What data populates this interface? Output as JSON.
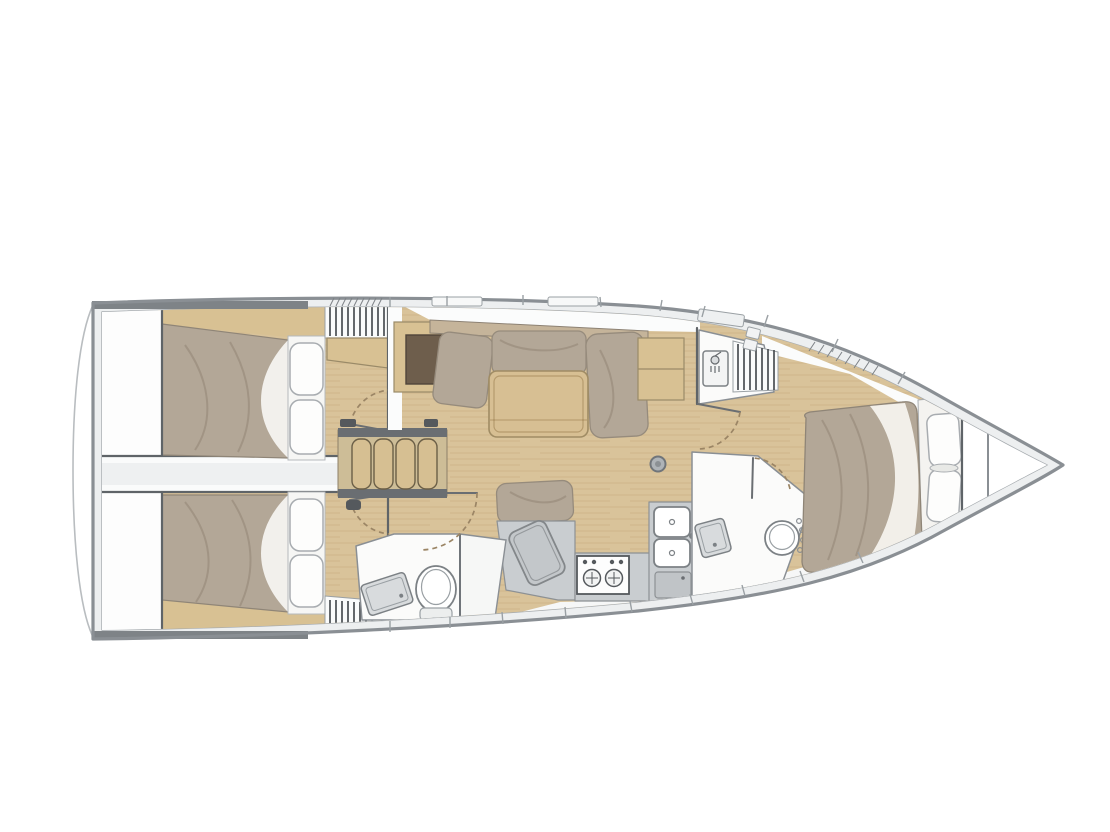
{
  "diagram": {
    "type": "sailboat-interior-floor-plan",
    "orientation": "bow-right-stern-left",
    "cabin_count": 3,
    "head_count": 2,
    "areas": [
      {
        "id": "transom-platform",
        "label": "transom swim platform"
      },
      {
        "id": "aft-cabin-port",
        "label": "aft double cabin (top)"
      },
      {
        "id": "aft-cabin-starboard",
        "label": "aft double cabin (bottom)"
      },
      {
        "id": "engine-compartment",
        "label": "engine compartment passage"
      },
      {
        "id": "companionway-steps",
        "label": "companionway steps"
      },
      {
        "id": "salon",
        "label": "salon with U-settee and table"
      },
      {
        "id": "chart-table",
        "label": "nav / chart table"
      },
      {
        "id": "galley",
        "label": "galley with stove, double sink, top-load locker"
      },
      {
        "id": "aft-head",
        "label": "aft head with toilet, sink and shower"
      },
      {
        "id": "forward-head",
        "label": "forward head with toilet and sink"
      },
      {
        "id": "forward-shower",
        "label": "forward shower compartment"
      },
      {
        "id": "forward-cabin",
        "label": "forward island-berth cabin"
      },
      {
        "id": "anchor-locker",
        "label": "bow anchor locker"
      },
      {
        "id": "mast-post",
        "label": "mast compression post"
      }
    ]
  },
  "palette": {
    "hull": "#8a8f94",
    "deck": "#edeff0",
    "floor": "#d9c39a",
    "wood": "#d8c193",
    "wood_dark": "#6e5e4c",
    "duvet": "#b3a797",
    "cushion": "#b3a797",
    "counter": "#c9cdd0",
    "chart_table": "#c3c7ca",
    "white_room": "#fbfbfa",
    "corridor": "#fafbfb",
    "stern_bar": "#7e8387",
    "step_wood": "#d6bf92",
    "door_arc": "#9b8565"
  }
}
